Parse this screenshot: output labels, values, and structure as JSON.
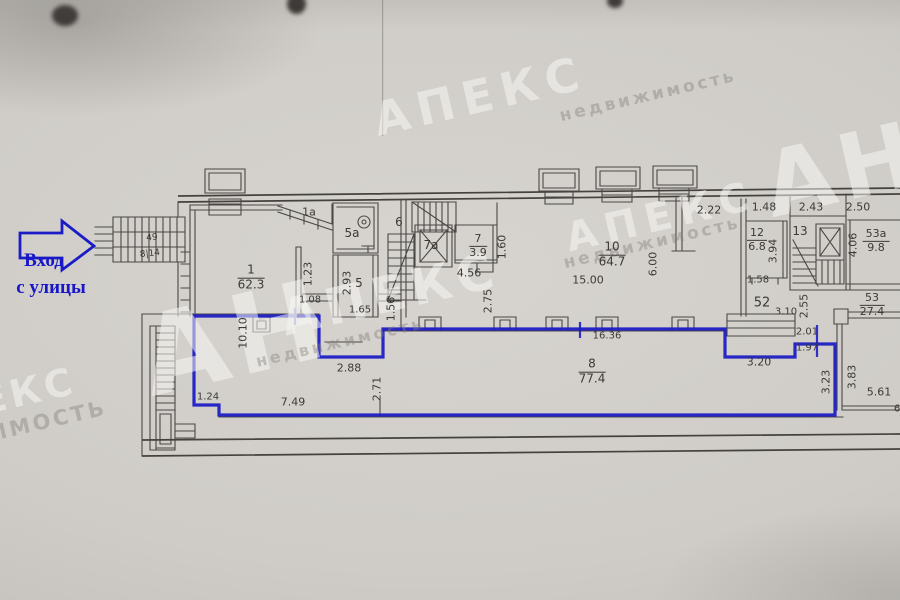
{
  "entrance": {
    "line1": "Вход",
    "line2": "с улицы"
  },
  "colors": {
    "blue_outline": "#1e1ec4",
    "pencil_line": "#4a4845",
    "paper": "#cfccc7"
  },
  "watermarks": [
    {
      "text": "АПЕКС",
      "x": 480,
      "y": 96,
      "fs": 46,
      "ls": 8,
      "tone": "white"
    },
    {
      "text": "недвижимость",
      "x": 648,
      "y": 96,
      "fs": 17,
      "ls": 3,
      "tone": "gray"
    },
    {
      "text": "АН",
      "x": 842,
      "y": 170,
      "fs": 90,
      "ls": 6,
      "tone": "white"
    },
    {
      "text": "АПЕКС",
      "x": 661,
      "y": 217,
      "fs": 40,
      "ls": 8,
      "tone": "white"
    },
    {
      "text": "недвижимость",
      "x": 652,
      "y": 243,
      "fs": 17,
      "ls": 3,
      "tone": "gray"
    },
    {
      "text": "АН",
      "x": 235,
      "y": 338,
      "fs": 110,
      "ls": 6,
      "tone": "white"
    },
    {
      "text": "АПЕКС",
      "x": 390,
      "y": 294,
      "fs": 50,
      "ls": 6,
      "tone": "white"
    },
    {
      "text": "недвижимость",
      "x": 340,
      "y": 342,
      "fs": 16,
      "ls": 3,
      "tone": "gray"
    },
    {
      "text": "ЕКС",
      "x": 28,
      "y": 391,
      "fs": 38,
      "ls": 4,
      "tone": "white"
    },
    {
      "text": "ЖИМОСТЬ",
      "x": 34,
      "y": 424,
      "fs": 21,
      "ls": 3,
      "tone": "gray"
    }
  ],
  "plan": {
    "labels": [
      {
        "t": "49",
        "x": 152,
        "y": 238,
        "fs": 9,
        "r": -6,
        "k": "room"
      },
      {
        "t": "8|14",
        "x": 150,
        "y": 254,
        "fs": 9,
        "r": -6,
        "k": "room"
      },
      {
        "t": "1a",
        "x": 309,
        "y": 212,
        "fs": 11,
        "k": "room"
      },
      {
        "t": "5a",
        "x": 352,
        "y": 233,
        "fs": 12,
        "k": "room"
      },
      {
        "t": "5",
        "x": 359,
        "y": 283,
        "fs": 12,
        "k": "room"
      },
      {
        "t": "6",
        "x": 399,
        "y": 222,
        "fs": 12,
        "k": "room"
      },
      {
        "t": "7a",
        "x": 431,
        "y": 245,
        "fs": 12,
        "k": "room"
      },
      {
        "t": "13",
        "x": 800,
        "y": 231,
        "fs": 12,
        "k": "room"
      },
      {
        "t": "52",
        "x": 762,
        "y": 303,
        "fs": 13,
        "k": "room"
      },
      {
        "t": "2.22",
        "x": 709,
        "y": 210,
        "k": "dim"
      },
      {
        "t": "1.48",
        "x": 764,
        "y": 207,
        "k": "dim"
      },
      {
        "t": "2.43",
        "x": 811,
        "y": 207,
        "k": "dim"
      },
      {
        "t": "2.50",
        "x": 858,
        "y": 207,
        "k": "dim"
      },
      {
        "t": "1.60",
        "x": 502,
        "y": 247,
        "r": -90,
        "k": "dim"
      },
      {
        "t": "4.56",
        "x": 469,
        "y": 273,
        "k": "dim"
      },
      {
        "t": "2.93",
        "x": 347,
        "y": 283,
        "r": -90,
        "k": "dim"
      },
      {
        "t": "1.23",
        "x": 308,
        "y": 274,
        "r": -90,
        "k": "dim"
      },
      {
        "t": "1.08",
        "x": 310,
        "y": 300,
        "fs": 10,
        "k": "dim"
      },
      {
        "t": "1.65",
        "x": 360,
        "y": 310,
        "fs": 10,
        "k": "dim"
      },
      {
        "t": "1.56",
        "x": 391,
        "y": 309,
        "r": -90,
        "k": "dim"
      },
      {
        "t": "2.75",
        "x": 488,
        "y": 301,
        "r": -90,
        "k": "dim"
      },
      {
        "t": "6.00",
        "x": 653,
        "y": 264,
        "r": -90,
        "k": "dim"
      },
      {
        "t": "15.00",
        "x": 588,
        "y": 280,
        "k": "dim"
      },
      {
        "t": "3.94",
        "x": 773,
        "y": 251,
        "r": -90,
        "k": "dim"
      },
      {
        "t": "1.58",
        "x": 758,
        "y": 280,
        "fs": 10,
        "k": "dim"
      },
      {
        "t": "4.06",
        "x": 853,
        "y": 245,
        "r": -90,
        "k": "dim"
      },
      {
        "t": "3.10",
        "x": 786,
        "y": 312,
        "fs": 10,
        "k": "dim"
      },
      {
        "t": "2.55",
        "x": 804,
        "y": 306,
        "r": -90,
        "k": "dim"
      },
      {
        "t": "10.10",
        "x": 243,
        "y": 333,
        "r": -90,
        "k": "dim"
      },
      {
        "t": "2.88",
        "x": 349,
        "y": 368,
        "k": "dim"
      },
      {
        "t": "2.71",
        "x": 377,
        "y": 389,
        "r": -90,
        "k": "dim"
      },
      {
        "t": "1.24",
        "x": 208,
        "y": 397,
        "fs": 10,
        "k": "dim"
      },
      {
        "t": "7.49",
        "x": 293,
        "y": 402,
        "k": "dim"
      },
      {
        "t": "16.36",
        "x": 607,
        "y": 336,
        "fs": 10,
        "k": "dim"
      },
      {
        "t": "3.20",
        "x": 759,
        "y": 362,
        "k": "dim"
      },
      {
        "t": "2.01",
        "x": 807,
        "y": 332,
        "fs": 10,
        "k": "dim"
      },
      {
        "t": "1.97",
        "x": 807,
        "y": 348,
        "fs": 10,
        "k": "dim"
      },
      {
        "t": "3.23",
        "x": 826,
        "y": 382,
        "r": -90,
        "k": "dim"
      },
      {
        "t": "3.83",
        "x": 852,
        "y": 377,
        "r": -90,
        "k": "dim"
      },
      {
        "t": "5.61",
        "x": 879,
        "y": 392,
        "k": "dim"
      },
      {
        "t": "6",
        "x": 897,
        "y": 409,
        "fs": 10,
        "k": "dim"
      }
    ],
    "fractions": [
      {
        "num": "1",
        "den": "62.3",
        "x": 251,
        "y": 278,
        "fs": 12
      },
      {
        "num": "7",
        "den": "3.9",
        "x": 478,
        "y": 246,
        "fs": 11
      },
      {
        "num": "10",
        "den": "64.7",
        "x": 612,
        "y": 255,
        "fs": 12
      },
      {
        "num": "12",
        "den": "6.8",
        "x": 757,
        "y": 240,
        "fs": 11
      },
      {
        "num": "53a",
        "den": "9.8",
        "x": 876,
        "y": 241,
        "fs": 11
      },
      {
        "num": "53",
        "den": "27.4",
        "x": 872,
        "y": 305,
        "fs": 11
      },
      {
        "num": "8",
        "den": "77.4",
        "x": 592,
        "y": 372,
        "fs": 12
      }
    ]
  }
}
